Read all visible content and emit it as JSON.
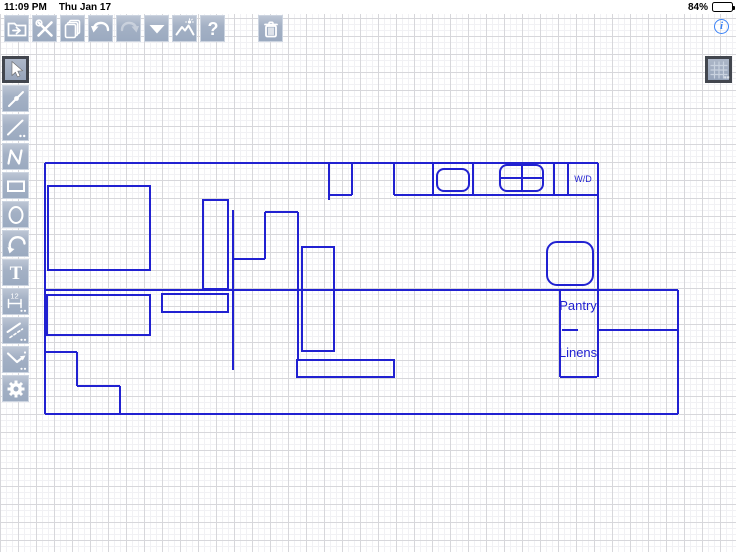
{
  "status_bar": {
    "time": "11:09 PM",
    "date": "Thu Jan 17",
    "battery_percent": "84%"
  },
  "info_button": {
    "glyph": "i"
  },
  "top_toolbar": {
    "buttons": [
      {
        "name": "file-export"
      },
      {
        "name": "tools"
      },
      {
        "name": "pages"
      },
      {
        "name": "undo"
      },
      {
        "name": "redo",
        "disabled": true
      },
      {
        "name": "dropdown"
      },
      {
        "name": "photo"
      },
      {
        "name": "help"
      },
      {
        "name": "trash",
        "gap_before": true
      }
    ]
  },
  "left_toolbar": {
    "buttons": [
      {
        "name": "pointer",
        "selected": true
      },
      {
        "name": "line-node"
      },
      {
        "name": "line-dashed"
      },
      {
        "name": "polyline"
      },
      {
        "name": "rectangle"
      },
      {
        "name": "ellipse"
      },
      {
        "name": "arc"
      },
      {
        "name": "text"
      },
      {
        "name": "dimension"
      },
      {
        "name": "parallel-lines"
      },
      {
        "name": "angle-snap"
      },
      {
        "name": "settings"
      }
    ]
  },
  "grid_button": {
    "name": "grid-toggle",
    "selected": true
  },
  "colors": {
    "plan_blue": "#2121d1",
    "toolbar_button": "#a3b0c4"
  },
  "floorplan": {
    "stroke_width": 2,
    "segments": [
      [
        45,
        163,
        598,
        163
      ],
      [
        45,
        163,
        45,
        414
      ],
      [
        45,
        414,
        678,
        414
      ],
      [
        598,
        163,
        598,
        377
      ],
      [
        45,
        290,
        678,
        290
      ],
      [
        678,
        290,
        678,
        414
      ],
      [
        597,
        330,
        678,
        330
      ],
      [
        560,
        290,
        560,
        377
      ],
      [
        560,
        377,
        597,
        377
      ],
      [
        562,
        330,
        578,
        330
      ],
      [
        394,
        195,
        598,
        195
      ],
      [
        394,
        163,
        394,
        195
      ],
      [
        433,
        163,
        433,
        195
      ],
      [
        473,
        163,
        473,
        195
      ],
      [
        554,
        163,
        554,
        195
      ],
      [
        568,
        163,
        568,
        195
      ],
      [
        329,
        163,
        329,
        200
      ],
      [
        352,
        163,
        352,
        195
      ],
      [
        329,
        195,
        352,
        195
      ],
      [
        233,
        210,
        233,
        370
      ],
      [
        233,
        259,
        265,
        259
      ],
      [
        265,
        212,
        265,
        259
      ],
      [
        265,
        212,
        298,
        212
      ],
      [
        298,
        212,
        298,
        360
      ],
      [
        45,
        352,
        77,
        352
      ],
      [
        77,
        352,
        77,
        386
      ],
      [
        77,
        386,
        120,
        386
      ],
      [
        120,
        386,
        120,
        414
      ],
      [
        522,
        165,
        522,
        191
      ],
      [
        500,
        178,
        543,
        178
      ]
    ],
    "rects": [
      [
        48,
        186,
        102,
        84
      ],
      [
        203,
        200,
        25,
        89
      ],
      [
        302,
        247,
        32,
        104
      ],
      [
        297,
        360,
        97,
        17
      ],
      [
        47,
        295,
        103,
        40
      ],
      [
        162,
        294,
        66,
        18
      ]
    ],
    "rounded_rects": [
      [
        437,
        169,
        32,
        22,
        7
      ],
      [
        500,
        165,
        43,
        26,
        7
      ],
      [
        547,
        242,
        46,
        43,
        10
      ]
    ],
    "labels": [
      {
        "text": "W/D",
        "x": 583,
        "y": 182,
        "size": 9
      },
      {
        "text": "Pantry",
        "x": 578,
        "y": 310,
        "size": 13
      },
      {
        "text": "Linens",
        "x": 578,
        "y": 357,
        "size": 13
      }
    ]
  }
}
